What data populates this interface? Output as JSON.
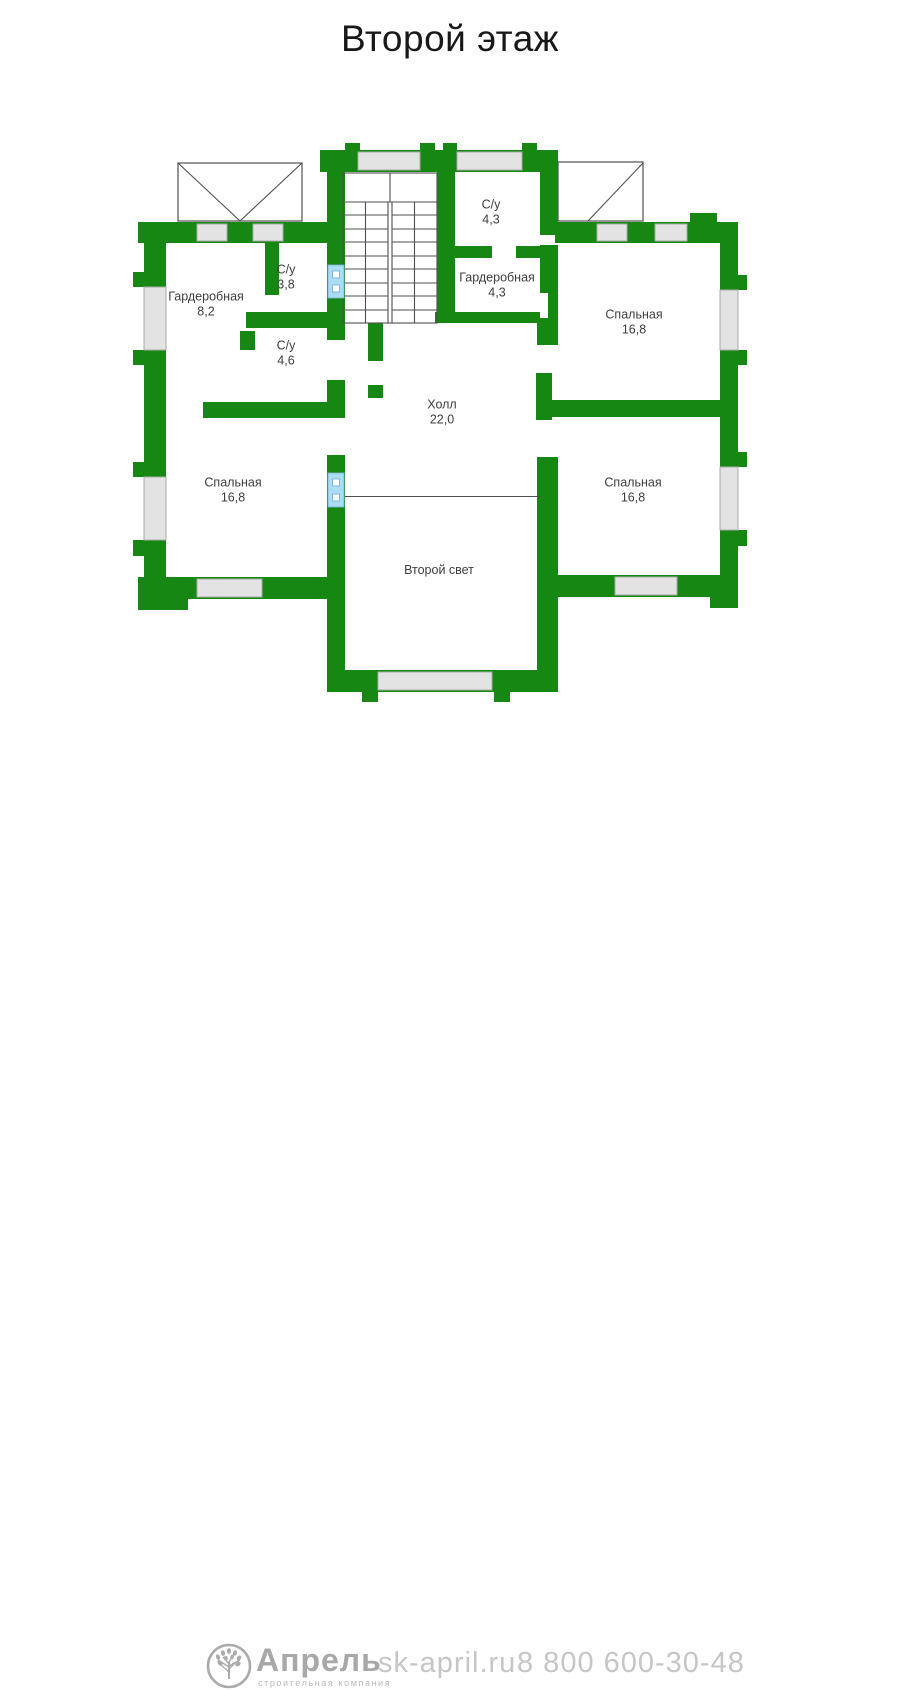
{
  "header": {
    "title": "Второй этаж"
  },
  "rooms": [
    {
      "name": "С/у",
      "area": "4,3"
    },
    {
      "name": "Гардеробная",
      "area": "4,3"
    },
    {
      "name": "Спальная",
      "area": "16,8"
    },
    {
      "name": "Гардеробная",
      "area": "8,2"
    },
    {
      "name": "С/у",
      "area": "3,8"
    },
    {
      "name": "С/у",
      "area": "4,6"
    },
    {
      "name": "Холл",
      "area": "22,0"
    },
    {
      "name": "Спальная",
      "area": "16,8"
    },
    {
      "name": "Спальная",
      "area": "16,8"
    },
    {
      "name": "Второй свет"
    }
  ],
  "footer": {
    "brand": "Апрель",
    "brand_subtitle": "строительная компания",
    "website": "sk-april.ru",
    "phone": "8 800 600-30-48"
  },
  "icons": {
    "logo": "tree-icon"
  },
  "colors": {
    "wall": "#178713",
    "window": "#e3e3e3",
    "door": "#aadcf5",
    "text": "#3e3e3e"
  }
}
